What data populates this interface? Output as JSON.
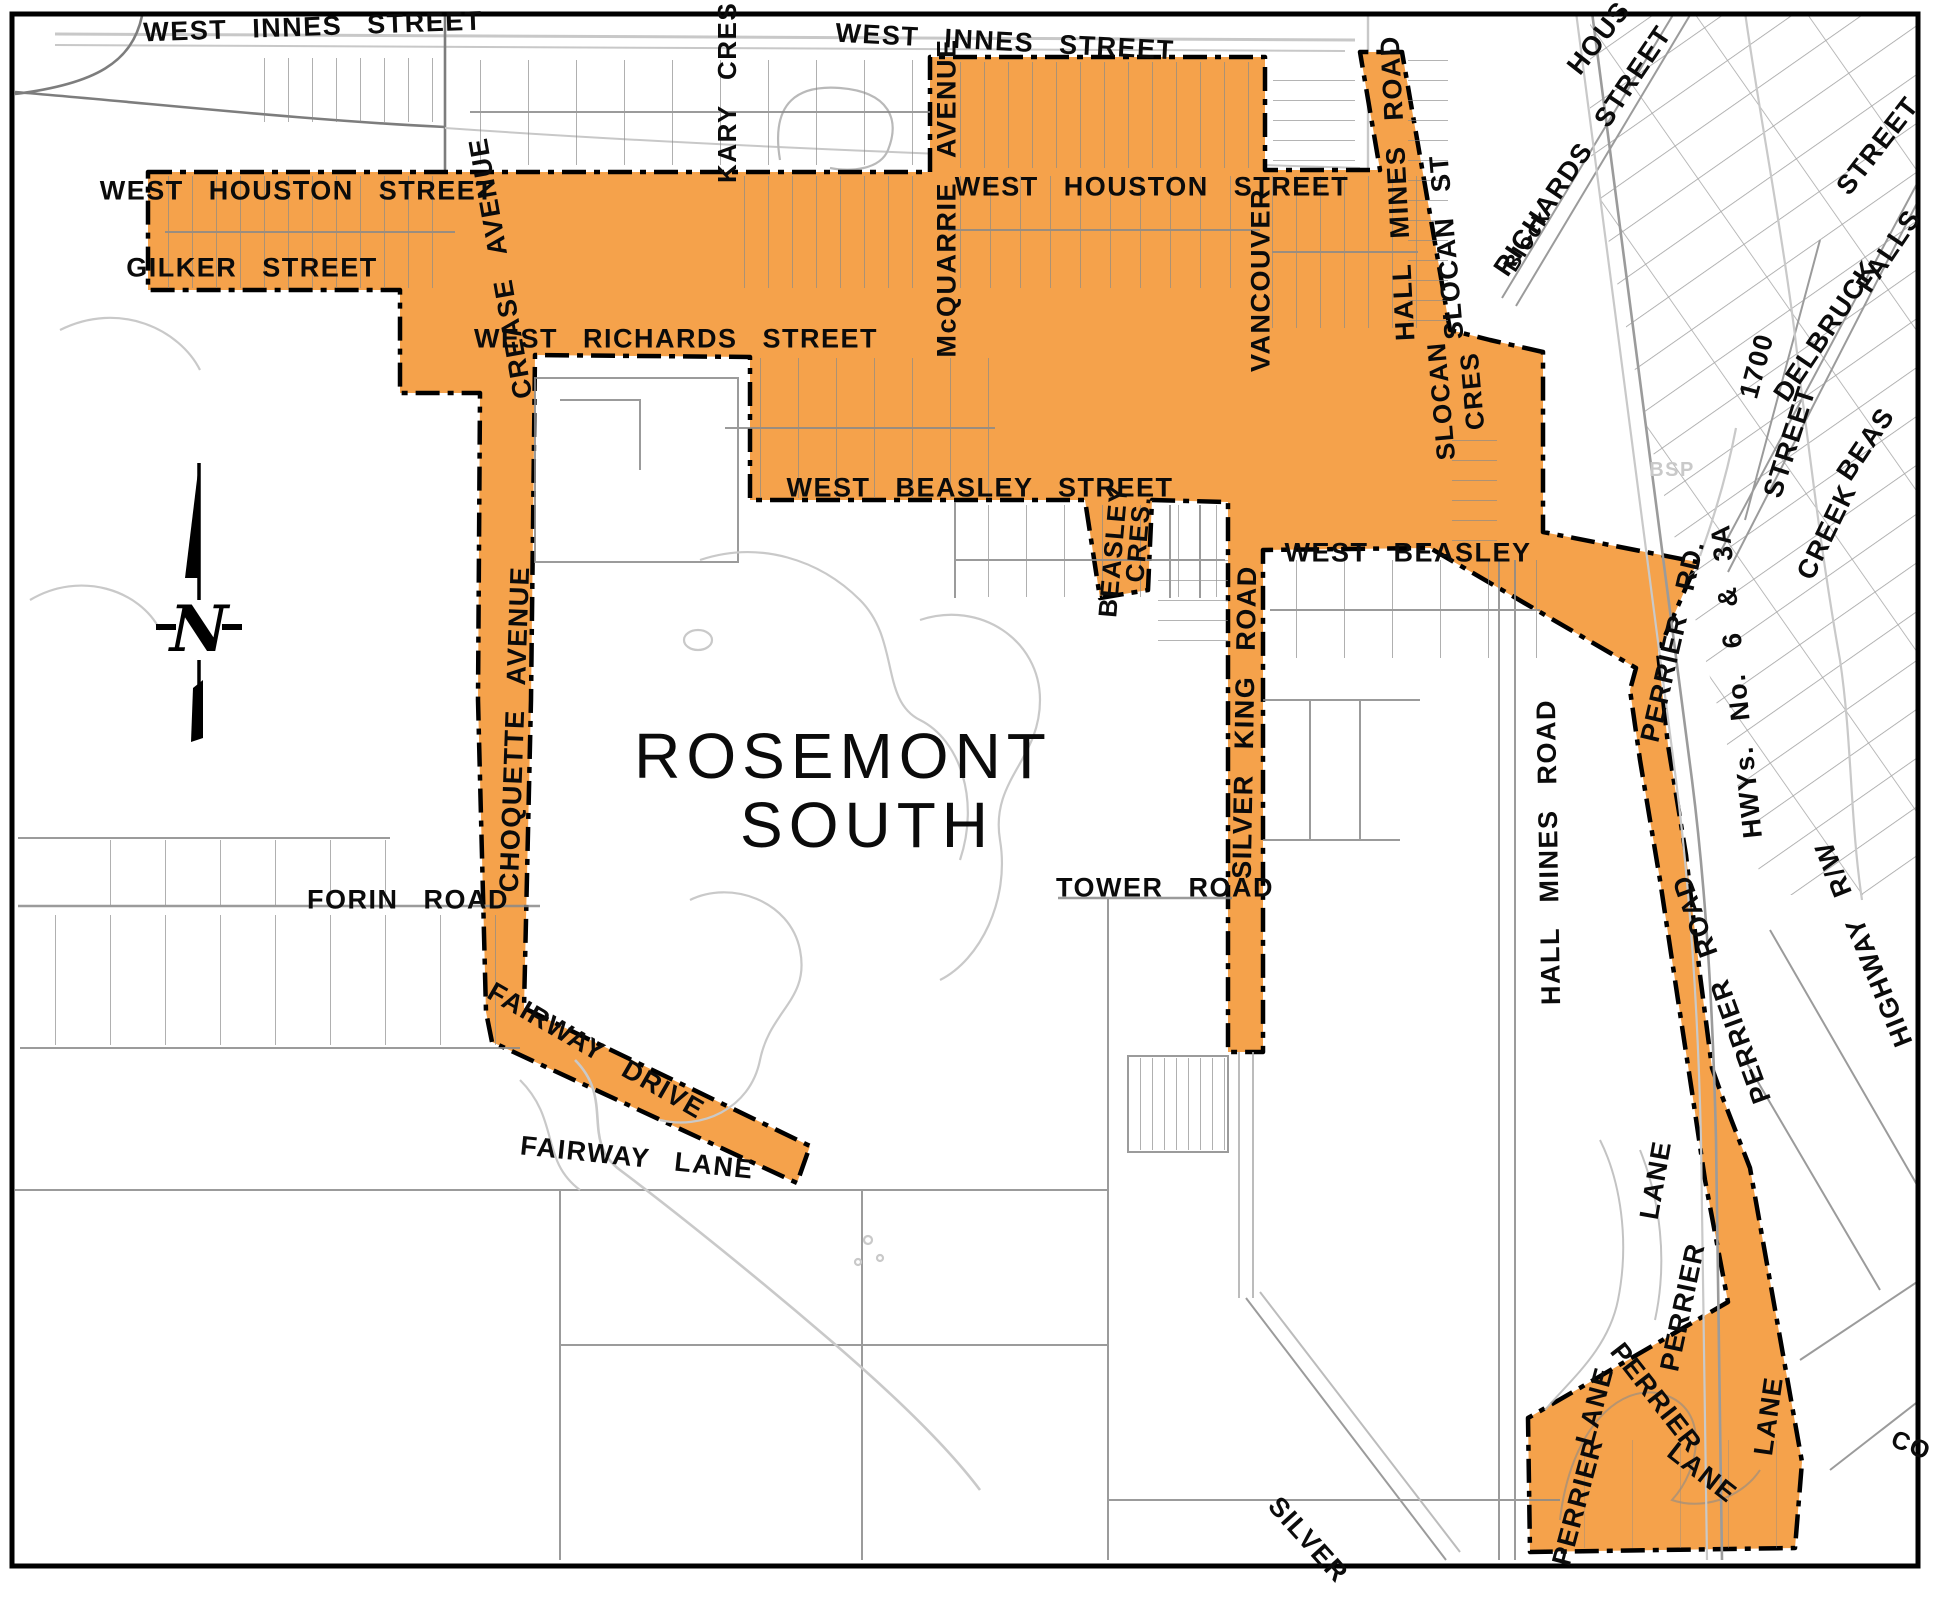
{
  "map": {
    "title": "ROSEMONT SOUTH",
    "compass": {
      "letter": "N"
    },
    "colors": {
      "region_fill": "#F5A24B",
      "boundary": "#000000",
      "parcel": "#8a8a8a",
      "parcel_light": "#c8c8c8",
      "label": "#0b0b0b",
      "faint_label": "#c9c9c9",
      "frame": "#000000"
    },
    "labels": [
      {
        "id": "innes-street-w",
        "text": "WEST INNES STREET",
        "x": 313,
        "y": 27,
        "r": -2,
        "s": 27
      },
      {
        "id": "innes-street-e",
        "text": "WEST INNES STREET",
        "x": 1005,
        "y": 42,
        "r": 3,
        "s": 27
      },
      {
        "id": "houston-street-w",
        "text": "WEST HOUSTON STREET",
        "x": 297,
        "y": 191,
        "r": 0,
        "s": 27
      },
      {
        "id": "houston-street-e",
        "text": "WEST HOUSTON STREET",
        "x": 1152,
        "y": 187,
        "r": 0,
        "s": 27
      },
      {
        "id": "gilker-street",
        "text": "GILKER STREET",
        "x": 252,
        "y": 268,
        "r": 0,
        "s": 27
      },
      {
        "id": "kary-cres",
        "text": "KARY CRES.",
        "x": 727,
        "y": 88,
        "r": -90,
        "s": 26
      },
      {
        "id": "crease-avenue",
        "text": "CREASE AVENUE",
        "x": 501,
        "y": 268,
        "r": -100,
        "s": 27
      },
      {
        "id": "richards-street-w",
        "text": "WEST RICHARDS STREET",
        "x": 676,
        "y": 339,
        "r": 0,
        "s": 27
      },
      {
        "id": "mcquarrie-avenue",
        "text": "McQUARRIE AVENUE",
        "x": 947,
        "y": 198,
        "r": -90,
        "s": 27
      },
      {
        "id": "vancouver",
        "text": "VANCOUVER",
        "x": 1261,
        "y": 280,
        "r": -90,
        "s": 27
      },
      {
        "id": "slocan-st",
        "text": "SLOCAN ST",
        "x": 1447,
        "y": 247,
        "r": -95,
        "s": 27
      },
      {
        "id": "hall-mines-road-ne",
        "text": "HALL MINES ROAD",
        "x": 1398,
        "y": 188,
        "r": -93,
        "s": 27
      },
      {
        "id": "block",
        "text": "Block",
        "x": 1527,
        "y": 241,
        "r": -58,
        "s": 22
      },
      {
        "id": "richards-street-ne",
        "text": "RICHARDS STREET",
        "x": 1583,
        "y": 151,
        "r": -56,
        "s": 27
      },
      {
        "id": "hous",
        "text": "HOUS",
        "x": 1599,
        "y": 38,
        "r": -52,
        "s": 27
      },
      {
        "id": "street-ne",
        "text": "STREET",
        "x": 1878,
        "y": 146,
        "r": -52,
        "s": 27
      },
      {
        "id": "street-1700-num",
        "text": "1700",
        "x": 1757,
        "y": 366,
        "r": -75,
        "s": 27
      },
      {
        "id": "street-1700",
        "text": "STREET",
        "x": 1790,
        "y": 442,
        "r": -72,
        "s": 27
      },
      {
        "id": "delbruck",
        "text": "DELBRUCK",
        "x": 1826,
        "y": 331,
        "r": -56,
        "s": 27
      },
      {
        "id": "falls",
        "text": "FALLS",
        "x": 1889,
        "y": 251,
        "r": -56,
        "s": 27
      },
      {
        "id": "beas",
        "text": "BEAS",
        "x": 1866,
        "y": 444,
        "r": -56,
        "s": 27
      },
      {
        "id": "creek",
        "text": "CREEK",
        "x": 1827,
        "y": 532,
        "r": -64,
        "s": 27
      },
      {
        "id": "bsp",
        "text": "BSP",
        "x": 1672,
        "y": 470,
        "r": 0,
        "s": 20,
        "c": "#c9c9c9"
      },
      {
        "id": "beasley-street-w",
        "text": "WEST BEASLEY STREET",
        "x": 980,
        "y": 488,
        "r": 0,
        "s": 27
      },
      {
        "id": "beasley-cres-1",
        "text": "BEASLEY",
        "x": 1113,
        "y": 551,
        "r": -85,
        "s": 26
      },
      {
        "id": "beasley-cres-2",
        "text": "CRES.",
        "x": 1138,
        "y": 539,
        "r": -85,
        "s": 26
      },
      {
        "id": "beasley-street-e",
        "text": "WEST BEASLEY",
        "x": 1408,
        "y": 553,
        "r": 0,
        "s": 27
      },
      {
        "id": "slocan-cres-1",
        "text": "SLOCAN",
        "x": 1441,
        "y": 401,
        "r": -95,
        "s": 26
      },
      {
        "id": "slocan-cres-2",
        "text": "CRES",
        "x": 1472,
        "y": 391,
        "r": -95,
        "s": 26
      },
      {
        "id": "perrier-rd",
        "text": "PERRIER RD.",
        "x": 1673,
        "y": 641,
        "r": -77,
        "s": 27
      },
      {
        "id": "hwys-6-3a",
        "text": "HWYs. No. 6 & 3A",
        "x": 1737,
        "y": 681,
        "r": -96,
        "s": 27
      },
      {
        "id": "silver-king-road",
        "text": "SILVER KING ROAD",
        "x": 1245,
        "y": 722,
        "r": -89,
        "s": 27
      },
      {
        "id": "hall-mines-road-c",
        "text": "HALL MINES ROAD",
        "x": 1549,
        "y": 852,
        "r": -91,
        "s": 27
      },
      {
        "id": "tower-road",
        "text": "TOWER ROAD",
        "x": 1165,
        "y": 888,
        "r": 0,
        "s": 27
      },
      {
        "id": "title-line1",
        "text": "ROSEMONT",
        "x": 843,
        "y": 756,
        "r": 0,
        "s": 64,
        "cls": "title"
      },
      {
        "id": "title-line2",
        "text": "SOUTH",
        "x": 867,
        "y": 825,
        "r": 0,
        "s": 64,
        "cls": "title"
      },
      {
        "id": "forin-road",
        "text": "FORIN ROAD",
        "x": 408,
        "y": 900,
        "r": 0,
        "s": 27
      },
      {
        "id": "choquette-avenue",
        "text": "CHOQUETTE AVENUE",
        "x": 515,
        "y": 729,
        "r": -88,
        "s": 27
      },
      {
        "id": "fairway-drive",
        "text": "FAIRWAY DRIVE",
        "x": 596,
        "y": 1051,
        "r": 30,
        "s": 27
      },
      {
        "id": "fairway-lane",
        "text": "FAIRWAY LANE",
        "x": 637,
        "y": 1158,
        "r": 6,
        "s": 27
      },
      {
        "id": "highway-rw",
        "text": "HIGHWAY R/W",
        "x": 1864,
        "y": 944,
        "r": -112,
        "s": 27
      },
      {
        "id": "perrier-road-s",
        "text": "PERRIER ROAD",
        "x": 1722,
        "y": 989,
        "r": -110,
        "s": 27
      },
      {
        "id": "lane-w",
        "text": "LANE",
        "x": 1656,
        "y": 1180,
        "r": -80,
        "s": 27
      },
      {
        "id": "perrier-mid",
        "text": "PERRIER",
        "x": 1683,
        "y": 1307,
        "r": -78,
        "s": 27
      },
      {
        "id": "perrier-inner",
        "text": "PERRIER",
        "x": 1656,
        "y": 1398,
        "r": 52,
        "s": 27
      },
      {
        "id": "lane-inner",
        "text": "LANE",
        "x": 1702,
        "y": 1473,
        "r": 38,
        "s": 27
      },
      {
        "id": "perrier-sw",
        "text": "PERRIER",
        "x": 1578,
        "y": 1502,
        "r": -75,
        "s": 27
      },
      {
        "id": "lane-sw",
        "text": "LANE",
        "x": 1595,
        "y": 1406,
        "r": -75,
        "s": 27
      },
      {
        "id": "lane-e",
        "text": "LANE",
        "x": 1769,
        "y": 1416,
        "r": -82,
        "s": 27
      },
      {
        "id": "silver-s",
        "text": "SILVER",
        "x": 1308,
        "y": 1540,
        "r": 48,
        "s": 27
      },
      {
        "id": "co",
        "text": "CO",
        "x": 1911,
        "y": 1446,
        "r": 22,
        "s": 25
      }
    ]
  }
}
